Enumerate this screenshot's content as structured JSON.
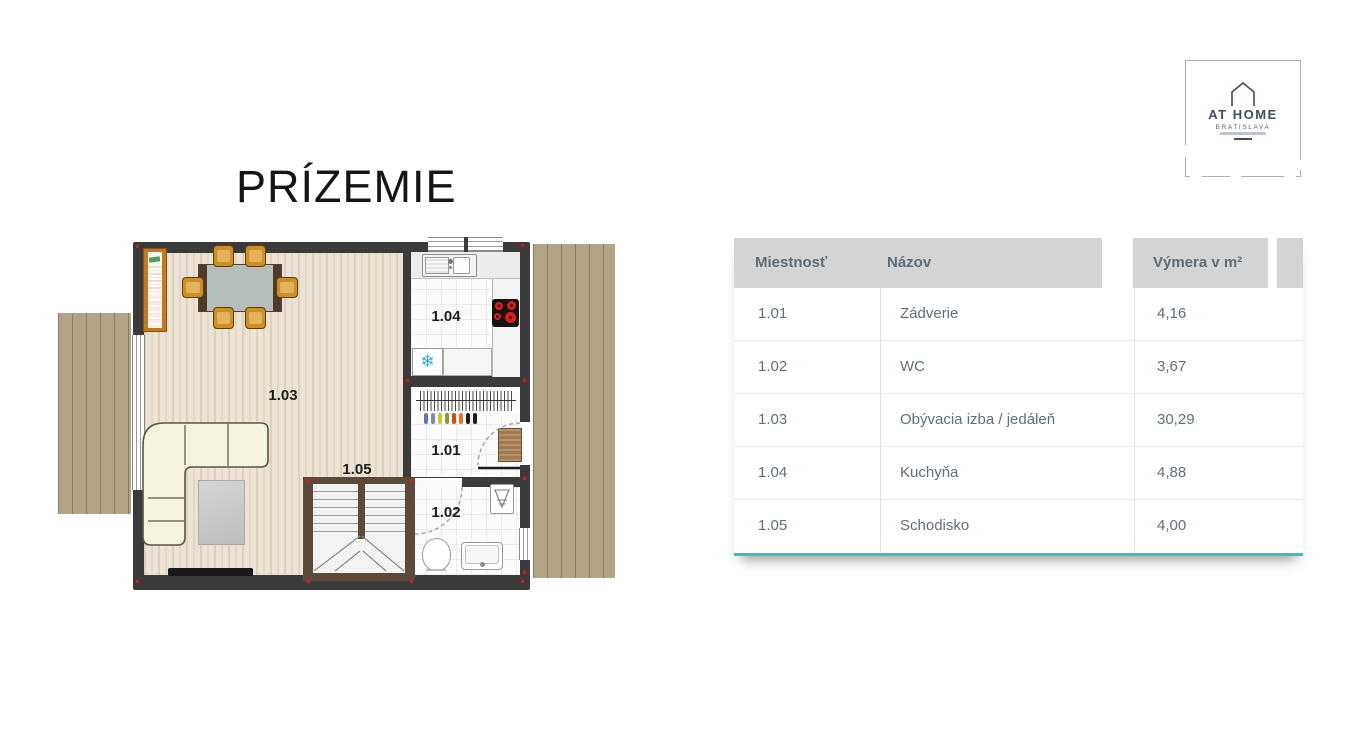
{
  "page": {
    "title": "PRÍZEMIE"
  },
  "logo": {
    "name": "AT HOME",
    "subtitle": "BRATISLAVA"
  },
  "plan": {
    "labels": {
      "r101": "1.01",
      "r102": "1.02",
      "r103": "1.03",
      "r104": "1.04",
      "r105": "1.05"
    }
  },
  "icons": {
    "snowflake": "❄"
  },
  "table": {
    "columns": [
      "Miestnosť",
      "Názov",
      "Výmera v m²"
    ],
    "rows": [
      {
        "id": "1.01",
        "name": "Zádverie",
        "area": "4,16"
      },
      {
        "id": "1.02",
        "name": "WC",
        "area": "3,67"
      },
      {
        "id": "1.03",
        "name": "Obývacia izba / jedáleň",
        "area": "30,29"
      },
      {
        "id": "1.04",
        "name": "Kuchyňa",
        "area": "4,88"
      },
      {
        "id": "1.05",
        "name": "Schodisko",
        "area": "4,00"
      }
    ]
  },
  "colors": {
    "accent_teal": "#2cc4c6",
    "wall_dark": "#3b3b3b",
    "terrace_tan": "#b2a484",
    "floor_beige": "#ece3d5",
    "logo_navy": "#3f4a69",
    "header_gray": "#d4d4d4",
    "table_text": "#5d6c79",
    "burner_red": "#e11b1b",
    "snowflake_blue": "#2da8e0",
    "stair_wood_brown": "#5b4a38",
    "corner_marker_red": "#e81212"
  }
}
